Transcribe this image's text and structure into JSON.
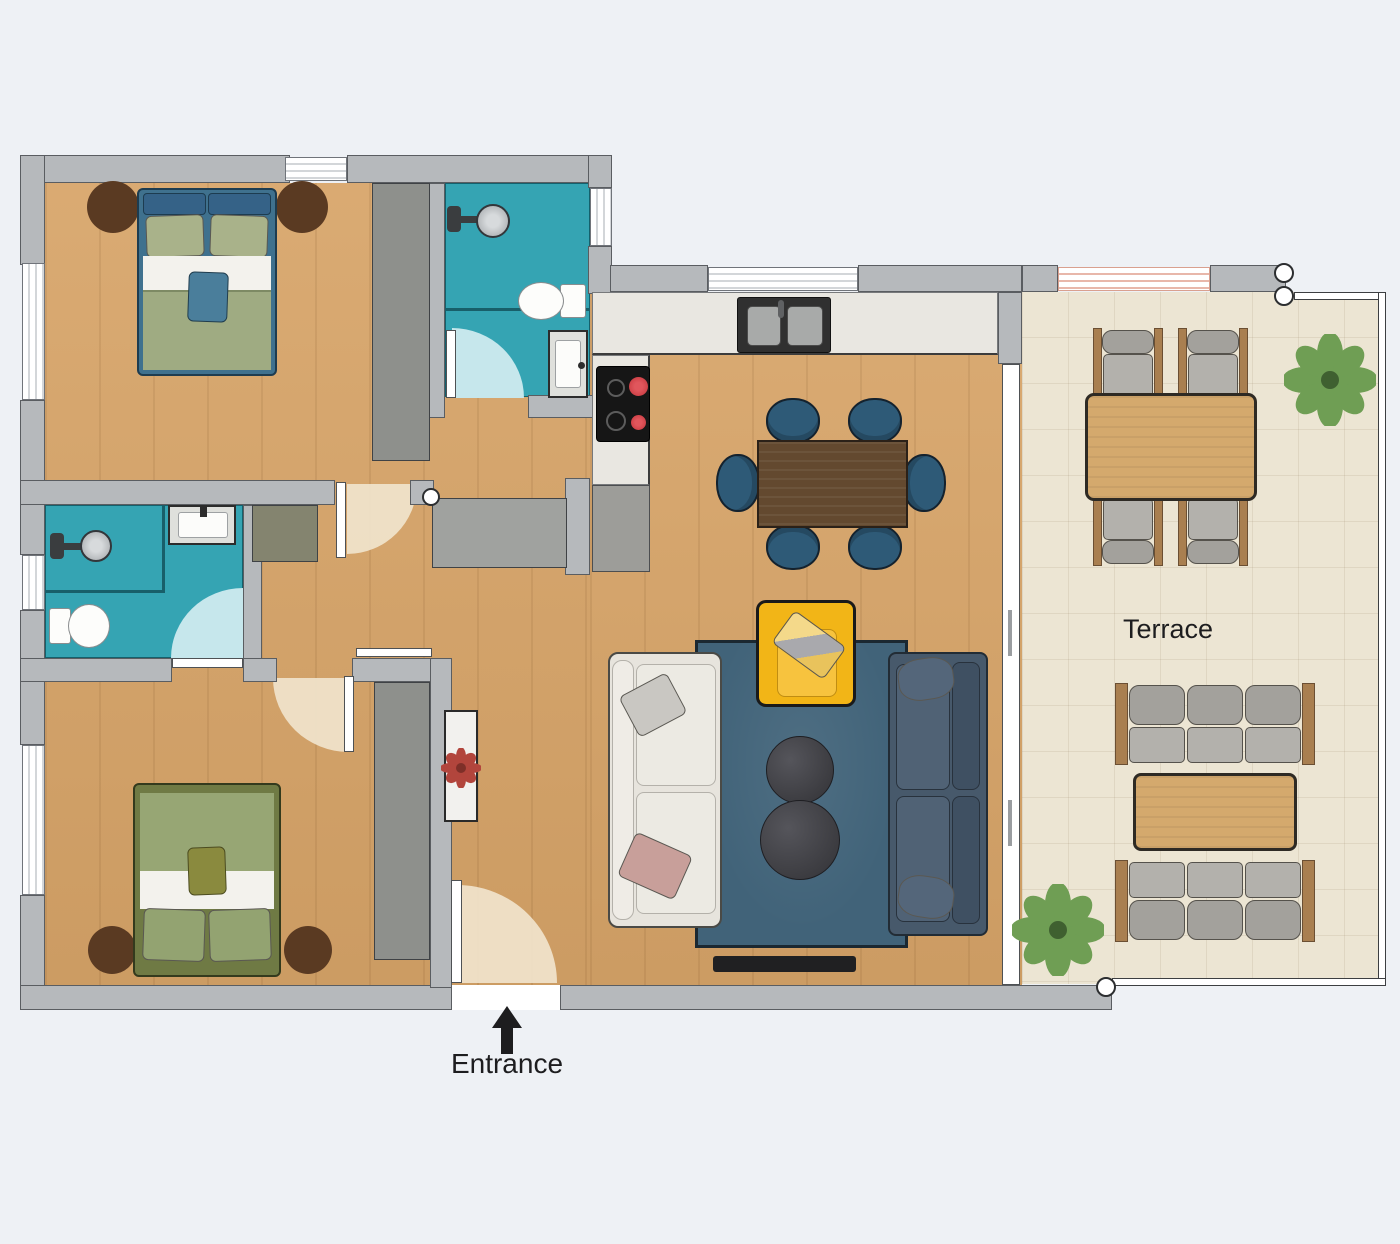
{
  "labels": {
    "terrace": "Terrace",
    "entrance": "Entrance"
  },
  "colors": {
    "background": "#eef1f5",
    "wall_fill": "#b6b9bc",
    "wall_outline": "#5a5d61",
    "wood": "#d7a468",
    "bath": "#35a4b3",
    "terrace_floor": "#ece5d3",
    "counter": "#e9e7e1",
    "cabinet": "#9d9d99",
    "closet": "#8e908c",
    "closet_olive": "#84846f",
    "rug": "#416379",
    "sofa_white": "#e7e4dd",
    "sofa_blue": "#47596b",
    "armchair_yellow": "#f2b517",
    "table_walnut": "#63492f",
    "chair_blue": "#2e5a77",
    "bed1_frame": "#3f718e",
    "bed2_frame": "#6f7a44",
    "bedding_green": "#9fab82",
    "bedding_green2": "#97a674",
    "nightstand_brown": "#5a3a22",
    "terrace_wood": "#d4a96d",
    "outdoor_cushion": "#b3b1ac",
    "wood_frame": "#a97f50",
    "plant_green": "#6f9e54",
    "flower_red": "#b2453c",
    "arc_beige": "#f0e3cb",
    "arc_blue": "#c6e7ec",
    "window_pink": "#e8b7aa",
    "stove_burner_red": "#c4343a",
    "ink": "#1d1d1f"
  }
}
